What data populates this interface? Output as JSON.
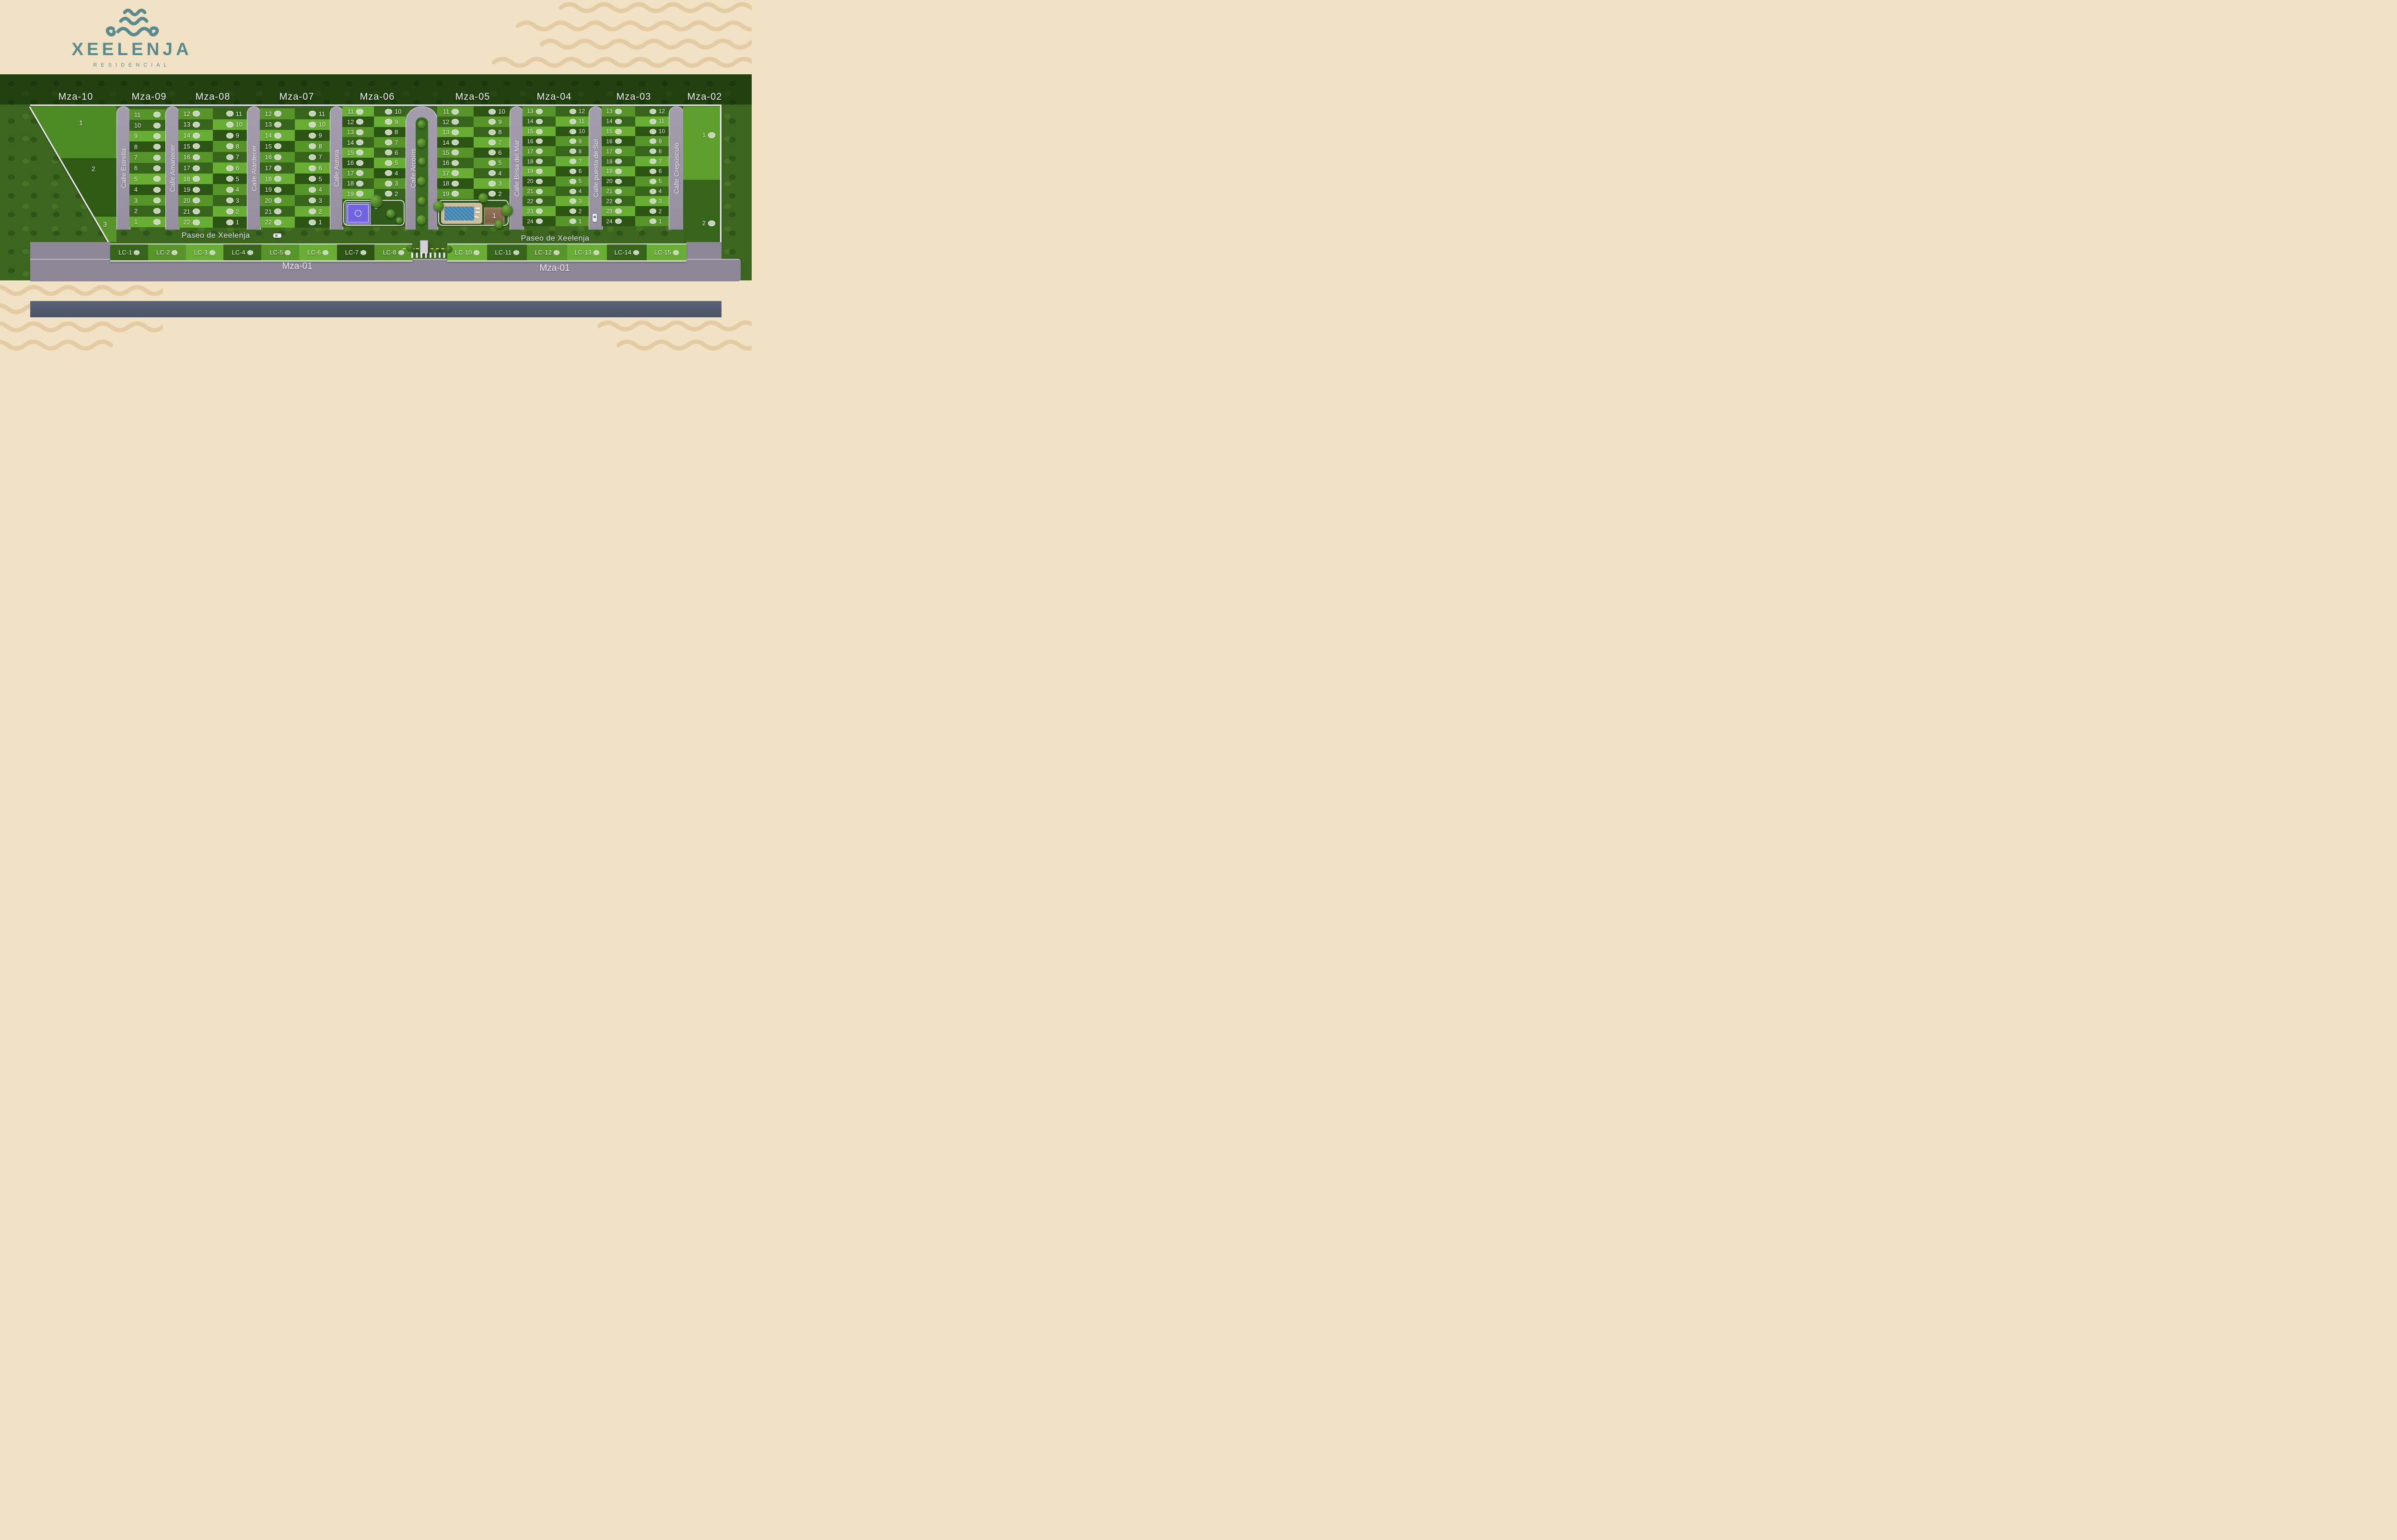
{
  "logo": {
    "title": "XEELENJA",
    "subtitle": "RESIDENCIAL"
  },
  "top_labels": [
    "Mza-10",
    "Mza-09",
    "Mza-08",
    "Mza-07",
    "Mza-06",
    "Mza-05",
    "Mza-04",
    "Mza-03",
    "Mza-02"
  ],
  "streets": [
    {
      "name": "Calle Estrella"
    },
    {
      "name": "Calle Amanecer"
    },
    {
      "name": "Calle Atardecer"
    },
    {
      "name": "Calle Aurora"
    },
    {
      "name": "Calle Arcoíris"
    },
    {
      "name": "Calle Brisa del Mar"
    },
    {
      "name": "Calle puesta de Sol"
    },
    {
      "name": "Calle Crepúsculo"
    }
  ],
  "blocks": {
    "mza10": {
      "label": "Mza-10",
      "lots": [
        "1",
        "2",
        "3"
      ]
    },
    "mza09": {
      "label": "Mza-09",
      "column": [
        "11",
        "10",
        "9",
        "8",
        "7",
        "6",
        "5",
        "4",
        "3",
        "2",
        "1"
      ]
    },
    "mza08": {
      "label": "Mza-08",
      "left": [
        "12",
        "13",
        "14",
        "15",
        "16",
        "17",
        "18",
        "19",
        "20",
        "21",
        "22"
      ],
      "right": [
        "11",
        "10",
        "9",
        "8",
        "7",
        "6",
        "5",
        "4",
        "3",
        "2",
        "1"
      ]
    },
    "mza07": {
      "label": "Mza-07",
      "left": [
        "12",
        "13",
        "14",
        "15",
        "16",
        "17",
        "18",
        "19",
        "20",
        "21",
        "22"
      ],
      "right": [
        "11",
        "10",
        "9",
        "8",
        "7",
        "6",
        "5",
        "4",
        "3",
        "2",
        "1"
      ]
    },
    "mza06": {
      "label": "Mza-06",
      "left": [
        "11",
        "12",
        "13",
        "14",
        "15",
        "16",
        "17",
        "18",
        "19"
      ],
      "right": [
        "10",
        "9",
        "8",
        "7",
        "6",
        "5",
        "4",
        "3",
        "2"
      ],
      "amenity": "1"
    },
    "mza05": {
      "label": "Mza-05",
      "left": [
        "11",
        "12",
        "13",
        "14",
        "15",
        "16",
        "17",
        "18",
        "19"
      ],
      "right": [
        "10",
        "9",
        "8",
        "7",
        "6",
        "5",
        "4",
        "3",
        "2"
      ],
      "amenity": "1"
    },
    "mza04": {
      "label": "Mza-04",
      "left": [
        "13",
        "14",
        "15",
        "16",
        "17",
        "18",
        "19",
        "20",
        "21",
        "22",
        "23",
        "24"
      ],
      "right": [
        "12",
        "11",
        "10",
        "9",
        "8",
        "7",
        "6",
        "5",
        "4",
        "3",
        "2",
        "1"
      ]
    },
    "mza03": {
      "label": "Mza-03",
      "left": [
        "13",
        "14",
        "15",
        "16",
        "17",
        "18",
        "19",
        "20",
        "21",
        "22",
        "23",
        "24"
      ],
      "right": [
        "12",
        "11",
        "10",
        "9",
        "8",
        "7",
        "6",
        "5",
        "4",
        "3",
        "2",
        "1"
      ]
    },
    "mza02": {
      "label": "Mza-02",
      "lots": [
        "1",
        "2"
      ]
    },
    "mza01": {
      "label": "Mza-01"
    }
  },
  "commercial": {
    "left": [
      "LC-1",
      "LC-2",
      "LC-3",
      "LC-4",
      "LC-5",
      "LC-6",
      "LC-7",
      "LC-8"
    ],
    "right": [
      "LC-10",
      "LC-11",
      "LC-12",
      "LC-13",
      "LC-14",
      "LC-15"
    ]
  },
  "roads": {
    "main_avenue": "Paseo de Xeelenja",
    "bottom_block": "Mza-01"
  },
  "colors": {
    "sand": "#f1e2c6",
    "wave_tan": "#e3c79e",
    "brand_teal": "#5b8a8c",
    "outer_green": "#3c661f",
    "road_dark": "#4e5669",
    "road_light": "#8d8798",
    "street_gray": "#9d96a7",
    "lot_dot": "#ccd6c4",
    "court_purple": "#7263e6",
    "pool_blue": "#4082b2",
    "building_brown": "#8a6a4e",
    "lot_greens": [
      "#57942a",
      "#35641a",
      "#68ae34",
      "#2c5413"
    ]
  }
}
